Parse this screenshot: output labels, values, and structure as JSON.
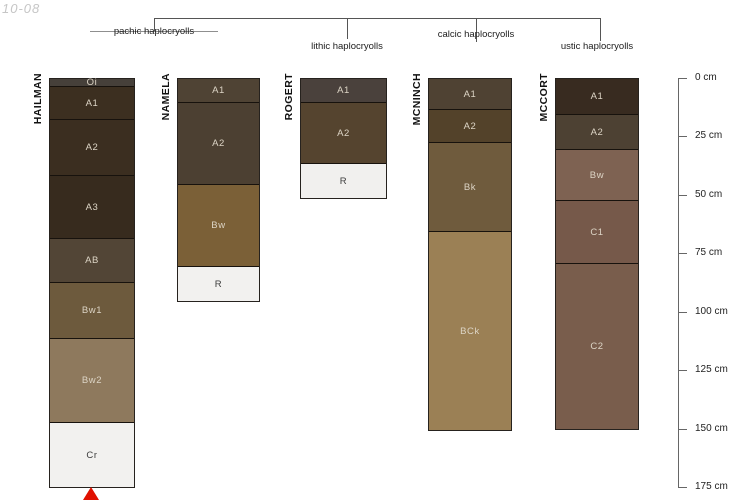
{
  "watermark": "10-08",
  "classification_tree": {
    "groups": [
      {
        "label": "pachic haplocryolls"
      },
      {
        "label": "lithic haplocryolls"
      },
      {
        "label": "calcic haplocryolls"
      },
      {
        "label": "ustic haplocryolls"
      }
    ]
  },
  "chart_data": {
    "type": "bar",
    "subtype": "soil-profile-columns",
    "depth_axis": {
      "unit": "cm",
      "min": 0,
      "max": 175,
      "tick_interval": 25,
      "ticks": [
        {
          "cm": 0,
          "label": "0 cm"
        },
        {
          "cm": 25,
          "label": "25 cm"
        },
        {
          "cm": 50,
          "label": "50 cm"
        },
        {
          "cm": 75,
          "label": "75 cm"
        },
        {
          "cm": 100,
          "label": "100 cm"
        },
        {
          "cm": 125,
          "label": "125 cm"
        },
        {
          "cm": 150,
          "label": "150 cm"
        },
        {
          "cm": 175,
          "label": "175 cm"
        }
      ]
    },
    "series": [
      {
        "name": "HAILMAN",
        "group": "pachic haplocryolls",
        "horizons": [
          {
            "label": "Oi",
            "top_cm": 0,
            "bottom_cm": 3,
            "color": "#46403a"
          },
          {
            "label": "A1",
            "top_cm": 3,
            "bottom_cm": 17,
            "color": "#3c2f20"
          },
          {
            "label": "A2",
            "top_cm": 17,
            "bottom_cm": 41,
            "color": "#3b2e20"
          },
          {
            "label": "A3",
            "top_cm": 41,
            "bottom_cm": 68,
            "color": "#372b1e"
          },
          {
            "label": "AB",
            "top_cm": 68,
            "bottom_cm": 87,
            "color": "#524536"
          },
          {
            "label": "Bw1",
            "top_cm": 87,
            "bottom_cm": 111,
            "color": "#6d5a3d"
          },
          {
            "label": "Bw2",
            "top_cm": 111,
            "bottom_cm": 147,
            "color": "#8e795d"
          },
          {
            "label": "Cr",
            "top_cm": 147,
            "bottom_cm": 175,
            "color": "#f2f1ef"
          }
        ]
      },
      {
        "name": "NAMELA",
        "group": "pachic haplocryolls",
        "horizons": [
          {
            "label": "A1",
            "top_cm": 0,
            "bottom_cm": 10,
            "color": "#4f4334"
          },
          {
            "label": "A2",
            "top_cm": 10,
            "bottom_cm": 45,
            "color": "#4c4032"
          },
          {
            "label": "Bw",
            "top_cm": 45,
            "bottom_cm": 80,
            "color": "#7b6037"
          },
          {
            "label": "R",
            "top_cm": 80,
            "bottom_cm": 95,
            "color": "#f2f1ef"
          }
        ]
      },
      {
        "name": "ROGERT",
        "group": "lithic haplocryolls",
        "horizons": [
          {
            "label": "A1",
            "top_cm": 0,
            "bottom_cm": 10,
            "color": "#4a413c"
          },
          {
            "label": "A2",
            "top_cm": 10,
            "bottom_cm": 36,
            "color": "#55442f"
          },
          {
            "label": "R",
            "top_cm": 36,
            "bottom_cm": 51,
            "color": "#f1f0ee"
          }
        ]
      },
      {
        "name": "MCNINCH",
        "group": "calcic haplocryolls",
        "horizons": [
          {
            "label": "A1",
            "top_cm": 0,
            "bottom_cm": 13,
            "color": "#4f4233"
          },
          {
            "label": "A2",
            "top_cm": 13,
            "bottom_cm": 27,
            "color": "#53422a"
          },
          {
            "label": "Bk",
            "top_cm": 27,
            "bottom_cm": 65,
            "color": "#6f5b3d"
          },
          {
            "label": "BCk",
            "top_cm": 65,
            "bottom_cm": 150,
            "color": "#9b8055"
          }
        ]
      },
      {
        "name": "MCCORT",
        "group": "ustic haplocryolls",
        "horizons": [
          {
            "label": "A1",
            "top_cm": 0,
            "bottom_cm": 15,
            "color": "#382b20"
          },
          {
            "label": "A2",
            "top_cm": 15,
            "bottom_cm": 30,
            "color": "#4d4133"
          },
          {
            "label": "Bw",
            "top_cm": 30,
            "bottom_cm": 52,
            "color": "#7e6252"
          },
          {
            "label": "C1",
            "top_cm": 52,
            "bottom_cm": 79,
            "color": "#76594a"
          },
          {
            "label": "C2",
            "top_cm": 79,
            "bottom_cm": 150,
            "color": "#795d4c"
          }
        ]
      }
    ],
    "marker": {
      "shape": "triangle-up",
      "color": "#e01000",
      "series": "HAILMAN",
      "depth_cm": 175
    }
  }
}
